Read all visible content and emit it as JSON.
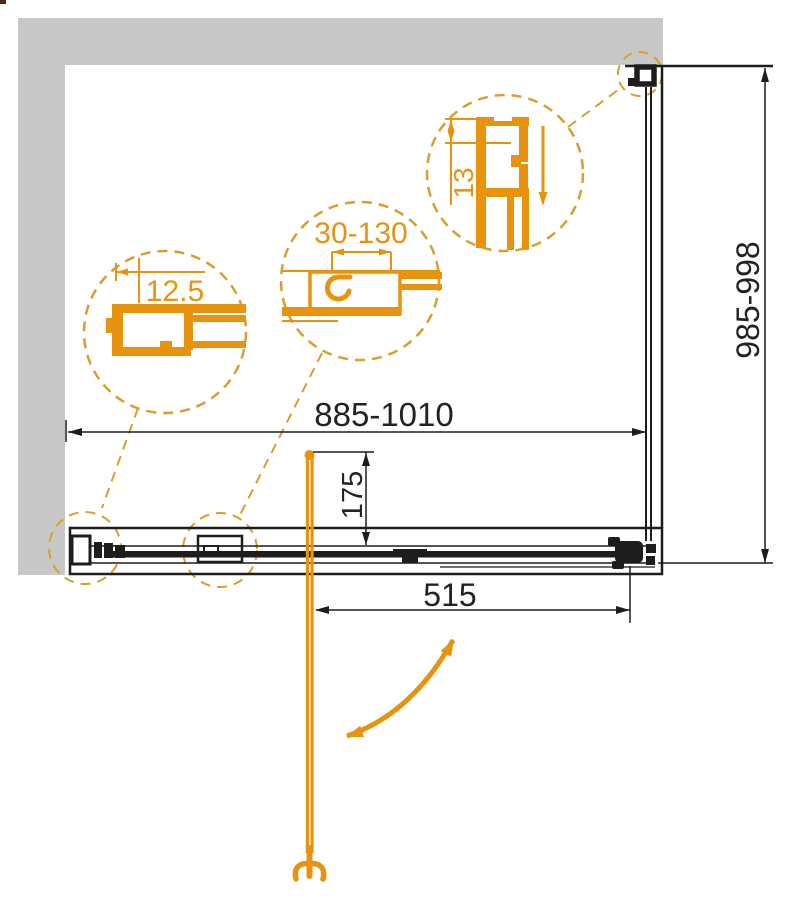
{
  "drawing": {
    "type": "shower-enclosure-technical-drawing",
    "labels": {
      "width_range": "885-1010",
      "height_range": "985-998",
      "door_width": "515",
      "handle_distance": "175",
      "detail_left_profile": "12.5",
      "detail_middle_adjustment": "30-130",
      "detail_right_depth": "13"
    },
    "colors": {
      "accent_orange": "#E8930E",
      "dash_orange": "#D99F2B",
      "wall_gray": "#C8C8C8",
      "line_black": "#1D1D1D"
    }
  }
}
